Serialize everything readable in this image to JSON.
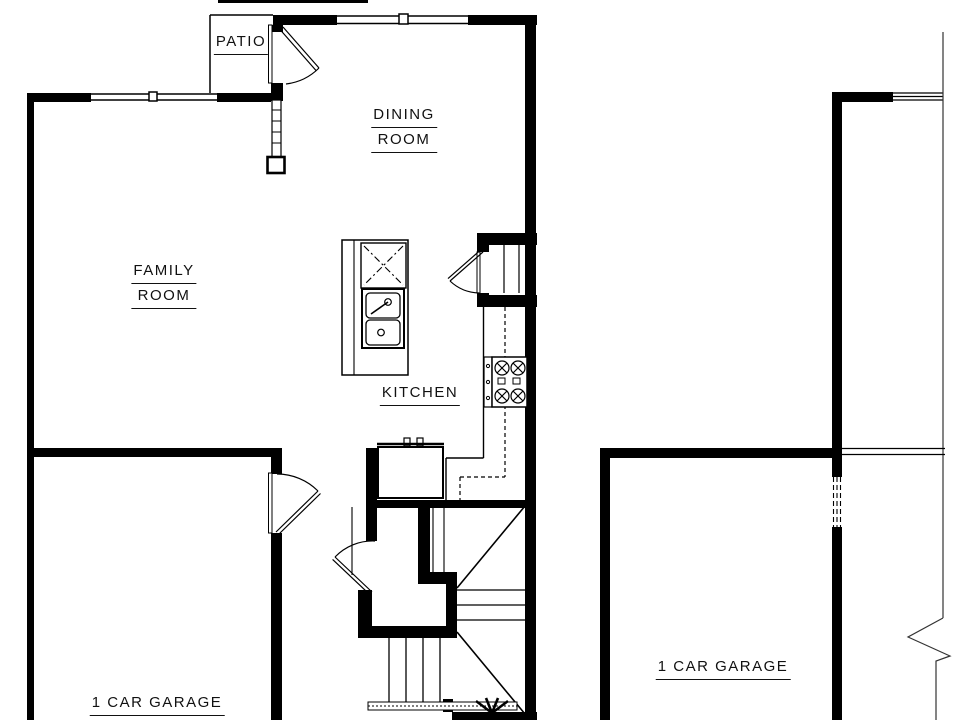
{
  "document": {
    "kind": "architectural floor plan, main level of a townhome unit with mirrored neighbor unit",
    "background_color": "#ffffff",
    "line_color": "#000000"
  },
  "rooms": {
    "patio": {
      "label": "PATIO"
    },
    "dining": {
      "line1": "DINING",
      "line2": "ROOM"
    },
    "family": {
      "line1": "FAMILY",
      "line2": "ROOM"
    },
    "kitchen": {
      "label": "KITCHEN"
    },
    "garage_left": {
      "label": "1 CAR GARAGE"
    },
    "garage_right": {
      "label": "1 CAR GARAGE"
    }
  },
  "fixtures": [
    "kitchen-island",
    "island-double-sink",
    "dishwasher",
    "cooktop-4-burner",
    "hall-sink-cabinet",
    "pantry-shelves",
    "staircase-up",
    "staircase-down",
    "patio-swing-door",
    "garage-entry-door",
    "front-entry-door",
    "pantry-door",
    "window-family-room",
    "window-dining-room",
    "window-neighbor-unit",
    "party-wall-break-line",
    "garage-firewall-window"
  ]
}
